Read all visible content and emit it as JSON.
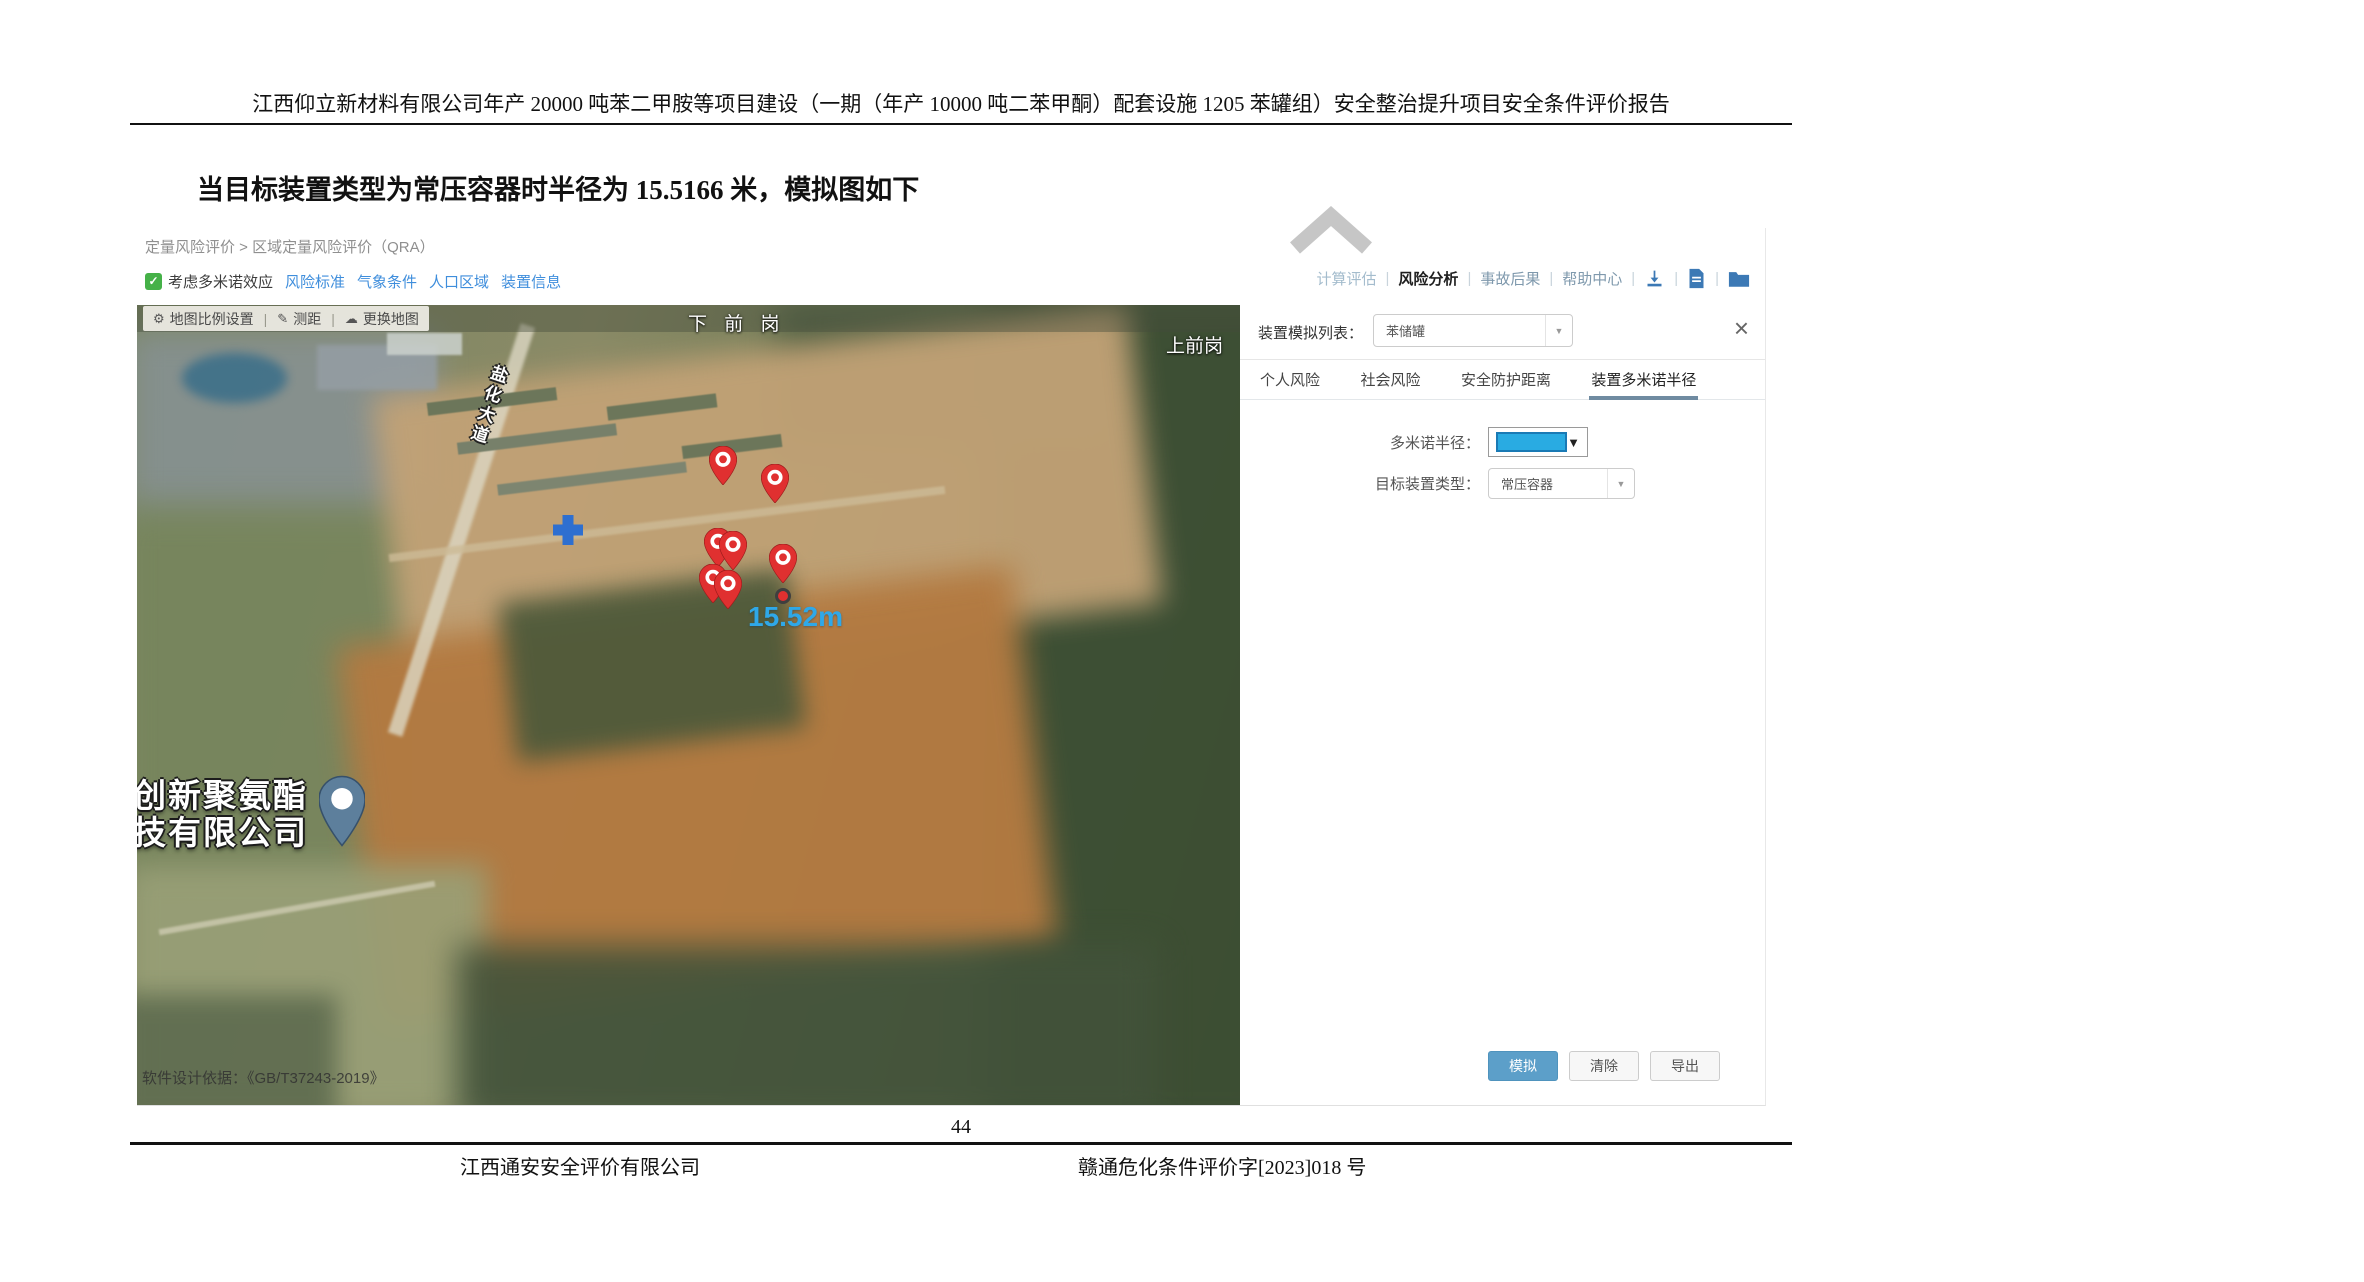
{
  "document": {
    "header_title": "江西仰立新材料有限公司年产 20000 吨苯二甲胺等项目建设（一期（年产 10000 吨二苯甲酮）配套设施 1205 苯罐组）安全整治提升项目安全条件评价报告",
    "body_text": "当目标装置类型为常压容器时半径为 15.5166 米，模拟图如下",
    "page_number": "44",
    "footer_left": "江西通安安全评价有限公司",
    "footer_right": "赣通危化条件评价字[2023]018 号"
  },
  "app": {
    "breadcrumb": "定量风险评价 > 区域定量风险评价（QRA）",
    "domino_checkbox": {
      "label": "考虑多米诺效应",
      "checked": true
    },
    "nav_links": [
      "风险标准",
      "气象条件",
      "人口区域",
      "装置信息"
    ],
    "toolbar": {
      "calc_label": "计算评估",
      "risk_label": "风险分析",
      "accident_label": "事故后果",
      "help_label": "帮助中心"
    },
    "map": {
      "toolbar": {
        "scale_label": "地图比例设置",
        "measure_label": "测距",
        "switch_label": "更换地图"
      },
      "place_labels": {
        "top": "下 前 岗",
        "top_right": "上前岗",
        "road": "盐化大道",
        "company_line1": "创新聚氨酯",
        "company_line2": "技有限公司"
      },
      "measurement_label": "15.52m",
      "watermark": "软件设计依据：《GB/T37243-2019》",
      "colors": {
        "pin_red": "#E03030",
        "measure_blue": "#2FA8E8",
        "plus_blue": "#2E6FD0",
        "company_pin": "#5D7F9C"
      },
      "markers": [
        {
          "type": "pin",
          "x": 586,
          "y": 185
        },
        {
          "type": "pin",
          "x": 638,
          "y": 203
        },
        {
          "type": "pin",
          "x": 581,
          "y": 267
        },
        {
          "type": "pin",
          "x": 596,
          "y": 270
        },
        {
          "type": "pin",
          "x": 576,
          "y": 303
        },
        {
          "type": "pin",
          "x": 591,
          "y": 309
        },
        {
          "type": "pin",
          "x": 646,
          "y": 283
        },
        {
          "type": "dot",
          "x": 646,
          "y": 291
        }
      ]
    },
    "panel": {
      "list_label": "装置模拟列表：",
      "list_value": "苯储罐",
      "close_icon": "×",
      "tabs": [
        "个人风险",
        "社会风险",
        "安全防护距离",
        "装置多米诺半径"
      ],
      "active_tab": "装置多米诺半径",
      "domino_radius_label": "多米诺半径：",
      "radius_swatch_color": "#29ABE2",
      "target_type_label": "目标装置类型：",
      "target_type_value": "常压容器",
      "buttons": {
        "simulate": "模拟",
        "clear": "清除",
        "export": "导出"
      }
    }
  }
}
